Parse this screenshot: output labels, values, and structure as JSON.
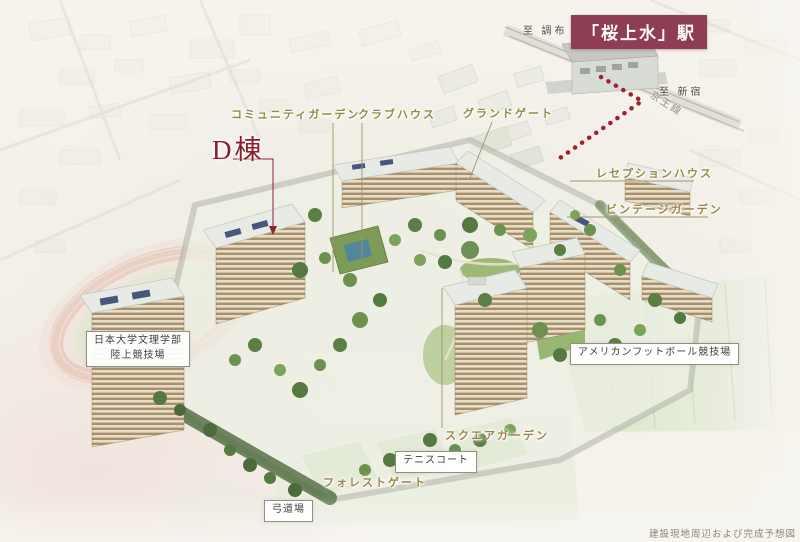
{
  "scene": {
    "caption": "建設現地周辺および完成予想図",
    "description": "aerial completion rendering of residential complex"
  },
  "station": {
    "to_chofu": "至 調布",
    "name": "「桜上水」駅",
    "to_shinjuku": "至 新宿",
    "rail_line": "京王線"
  },
  "building": {
    "d_wing": "D棟"
  },
  "facilities": [
    {
      "label": "コミュニティガーデン"
    },
    {
      "label": "クラブハウス"
    },
    {
      "label": "グランドゲート"
    },
    {
      "label": "レセプションハウス"
    },
    {
      "label": "ビンテージガーデン"
    },
    {
      "label": "スクエアガーデン"
    },
    {
      "label": "フォレストゲート"
    }
  ],
  "landmarks": {
    "university": {
      "line1": "日本大学文理学部",
      "line2": "陸上競技場"
    },
    "football": "アメリカンフットボール競技場",
    "tennis": "テニスコート",
    "kyudo": "弓道場"
  },
  "colors": {
    "station_box": "#8e3d55",
    "facility_label": "#9a8648",
    "d_wing_label": "#8b1e2d",
    "route_dots": "#a51f2e"
  }
}
